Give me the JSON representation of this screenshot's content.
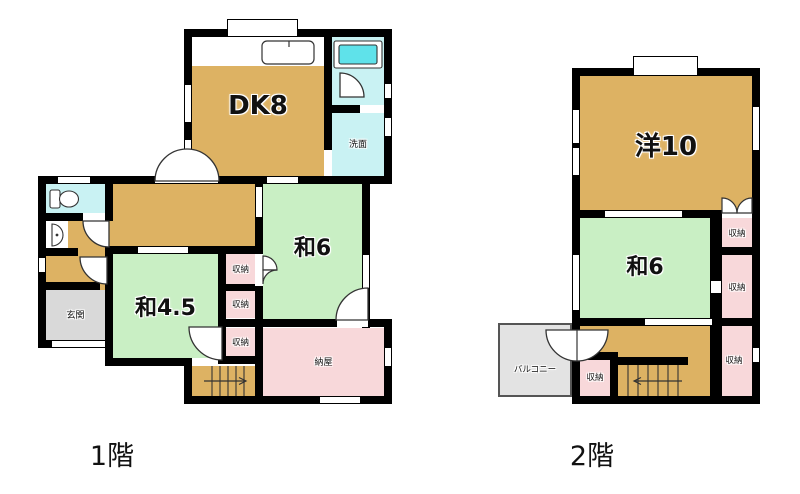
{
  "floor1": {
    "caption": "1階",
    "rooms": {
      "dk": "DK8",
      "washroom": "洗面",
      "wa6": "和6",
      "wa45": "和4.5",
      "genkan": "玄関",
      "naya": "納屋",
      "closet1": "収納",
      "closet2": "収納",
      "closet3": "収納"
    }
  },
  "floor2": {
    "caption": "2階",
    "rooms": {
      "yo10": "洋10",
      "wa6": "和6",
      "closet_top": "収納",
      "closet_mid": "収納",
      "closet_bottom": "収納",
      "closet_hall": "収納",
      "balcony": "バルコニー"
    }
  },
  "palette": {
    "wall": "#000000",
    "wood_tan": "#ddb263",
    "tatami_green": "#c9efc4",
    "closet_pink": "#f8d8da",
    "wet_area_cyan": "#c9f2f3",
    "bathtub_cyan": "#5fe2ea",
    "entry_gray": "#d9d9d9",
    "balcony_gray": "#e3e3e3"
  }
}
